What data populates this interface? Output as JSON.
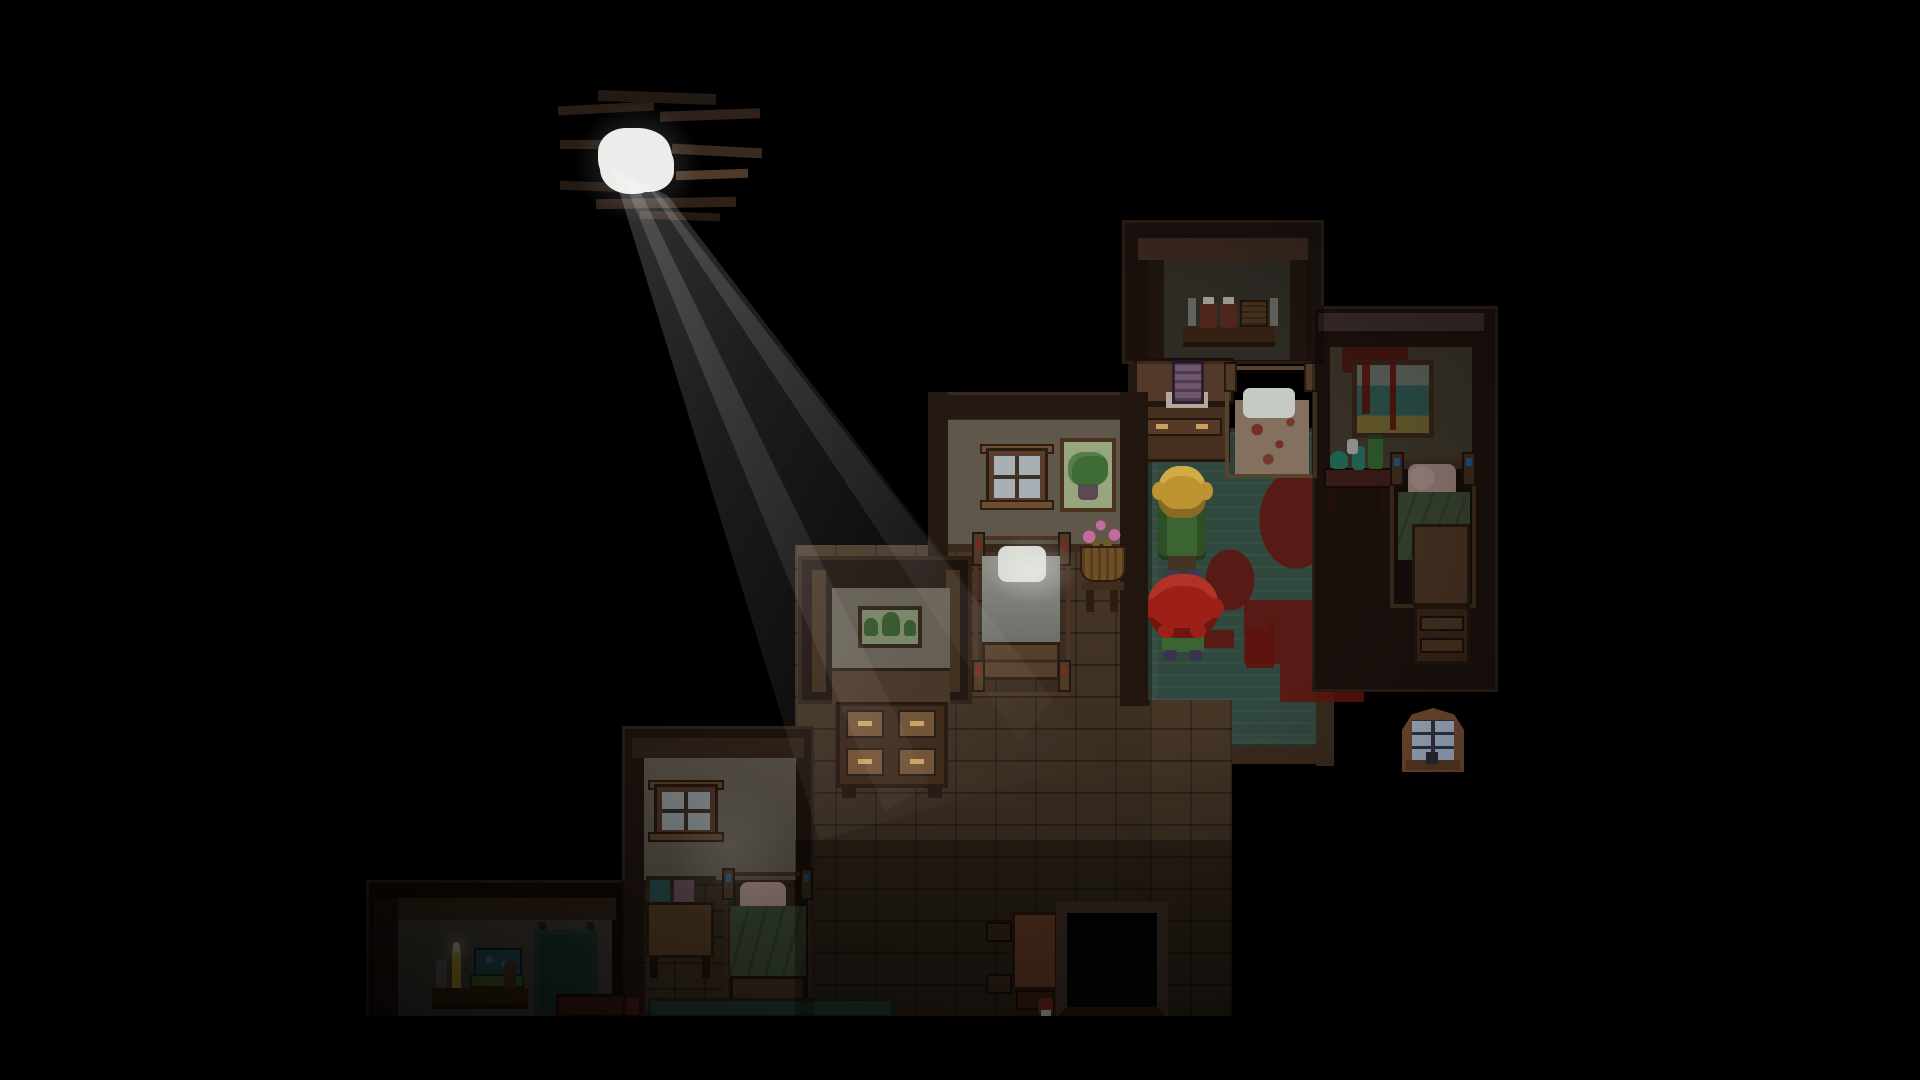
{
  "meta": {
    "type": "game-screenshot",
    "description": "Top-down pixel-art horror RPG scene: dark attic bedrooms arranged diagonally, a hole in the roof letting a light beam in, two characters standing on a blood-stained green carpet.",
    "visible_text": "none"
  },
  "scene": {
    "light": {
      "source": "hole-in-roof",
      "beam_direction": "down-right",
      "lit_objects": [
        "white-pillow-bed",
        "hallway-floor"
      ]
    },
    "characters": [
      {
        "id": "blonde-character",
        "description": "blonde wavy hair, green coat, brown pants, facing north"
      },
      {
        "id": "red-haired-character",
        "description": "huge bushy red hair, green skirt, facing north"
      }
    ],
    "rooms": [
      {
        "id": "shelf-room",
        "contents": [
          "wall shelf",
          "two red jars with white lids",
          "wicker basket",
          "two candles"
        ]
      },
      {
        "id": "painting-room",
        "contents": [
          "blood-splattered wall",
          "framed seascape painting with blood drips",
          "table with teal bottles",
          "bed with pink pillow and green blanket",
          "nightstand"
        ]
      },
      {
        "id": "carpet-room",
        "contents": [
          "green carpet",
          "blood splatters",
          "dresser with purple picture and white runner",
          "blood-stained bed with white pillow"
        ]
      },
      {
        "id": "window-room",
        "contents": [
          "window",
          "framed potted-plant painting",
          "bed with white pillow lit by beam",
          "basket of pink flowers on stand"
        ]
      },
      {
        "id": "alcove-room",
        "contents": [
          "framed painting of trees",
          "desk with four drawers"
        ]
      },
      {
        "id": "lower-window-room",
        "contents": [
          "window",
          "rack with teal and mauve towels",
          "bed with pink pillow and green blanket"
        ]
      },
      {
        "id": "bottom-left-room",
        "contents": [
          "shelf with books, bottles and a lit candle",
          "hanging dark-green cloth",
          "dark red bed edge"
        ]
      },
      {
        "id": "hallway",
        "contents": [
          "wood plank floor",
          "small red-brown table",
          "wall shelves",
          "small red bottle",
          "dark stair opening",
          "green carpet strip"
        ]
      }
    ],
    "isolated_elements": [
      "dormer-window-on-dark-roof",
      "roof-hole-with-light",
      "broken-roof-planks"
    ]
  },
  "palette": {
    "bg": "#000000",
    "wood-dark": "#241812",
    "wood-frame": "#3a2a1e",
    "wood-lintel": "#4e372b",
    "wood-mauve": "#4e3a38",
    "wall-gray": "#413b33",
    "wall-gray2": "#514b43",
    "wall-beige": "#5f5749",
    "wall-beige-bright": "#7c7466",
    "wall-beige-dim": "#4e4537",
    "floor": "#4c3b2a",
    "floor-dark": "#3f3223",
    "carpet": "#31483e",
    "carpet-strip": "#2a3e32",
    "blood": "#5f130d",
    "wood-mid": "#57402c",
    "wood-light": "#6e4f33",
    "wood-red": "#6e402c",
    "frame-brown": "#5a3d2a",
    "pane": "#a8b0b6",
    "pane-blue": "#9fb0c6",
    "pillow-white": "#d8d8d2",
    "pillow-pink": "#c2a29a",
    "sheet-gray": "#8f8f88",
    "blanket-green": "#49593f",
    "mattress": "#83705f",
    "hair-blonde": "#bd9431",
    "hair-blonde-light": "#d1ab45",
    "hair-red": "#9c2018",
    "hair-red-light": "#b23226",
    "coat-green": "#3c6431",
    "pants": "#433322",
    "shoes": "#3f3656",
    "bottle-teal": "#2f8a74",
    "bottle-green": "#3f7a3a",
    "jar-red": "#6e3526",
    "basket": "#5f4526",
    "book-teal": "#2e5a66",
    "book-green": "#4e6a32",
    "towel-teal": "#2e5a5a",
    "towel-mauve": "#7a5a68",
    "cloth-dark": "#243e38",
    "bed-red": "#4a1f18",
    "candle": "#c9b13a",
    "white": "#ececea",
    "painting-teal": "#3c6a62",
    "painting-sand": "#8a7a3c",
    "painting-sky": "#7c837b",
    "painting-plant": "#3f6b35",
    "painting-grass": "#97a67f",
    "picture-purple": "#6e566e",
    "flower-pink": "#c46a9e",
    "table-dark-red": "#4c2620",
    "brass": "#c9a05f"
  }
}
